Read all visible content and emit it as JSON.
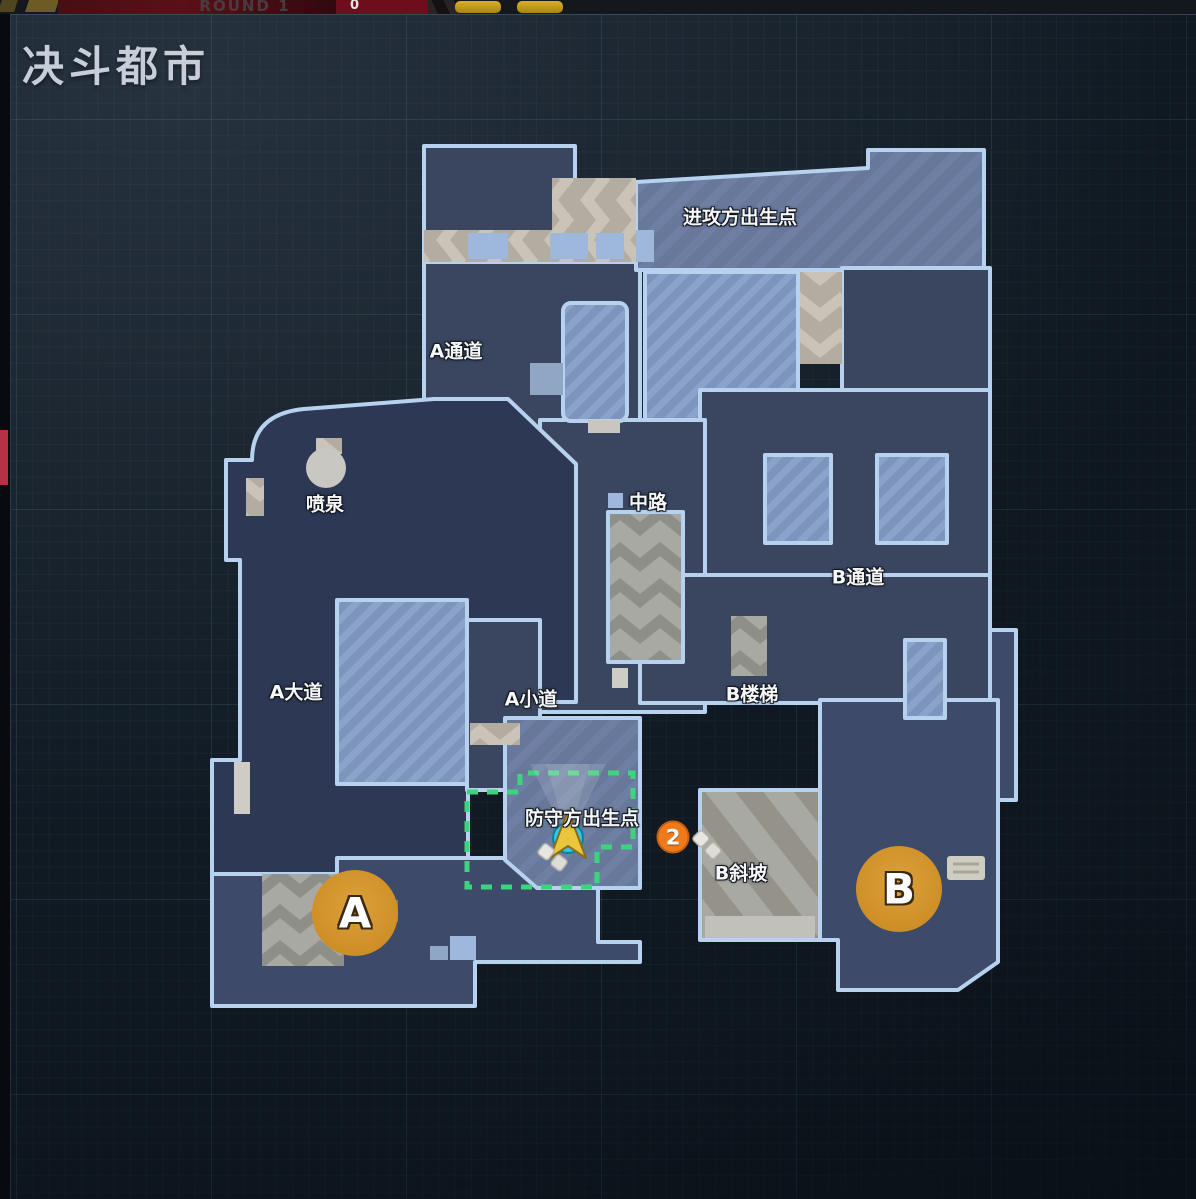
{
  "hud": {
    "round_label": "ROUND 1",
    "score": "0"
  },
  "map": {
    "title": "决斗都市",
    "labels": [
      {
        "name": "attacker-spawn",
        "text": "进攻方出生点"
      },
      {
        "name": "a-passage",
        "text": "A通道"
      },
      {
        "name": "fountain",
        "text": "喷泉"
      },
      {
        "name": "mid",
        "text": "中路"
      },
      {
        "name": "b-passage",
        "text": "B通道"
      },
      {
        "name": "a-avenue",
        "text": "A大道"
      },
      {
        "name": "a-path",
        "text": "A小道"
      },
      {
        "name": "b-stairs",
        "text": "B楼梯"
      },
      {
        "name": "defender-spawn",
        "text": "防守方出生点"
      },
      {
        "name": "b-ramp",
        "text": "B斜坡"
      }
    ],
    "sites": {
      "a": "A",
      "b": "B"
    },
    "ping_marker_number": "2",
    "colors": {
      "site_circle": "#d6952e",
      "ping_orange": "#ef7a1c",
      "player_cyan": "#35c5e8",
      "player_arrow_gold": "#e9c63b",
      "spawn_zone_green": "#3ed47d",
      "map_outline": "#b7d2ee"
    }
  }
}
